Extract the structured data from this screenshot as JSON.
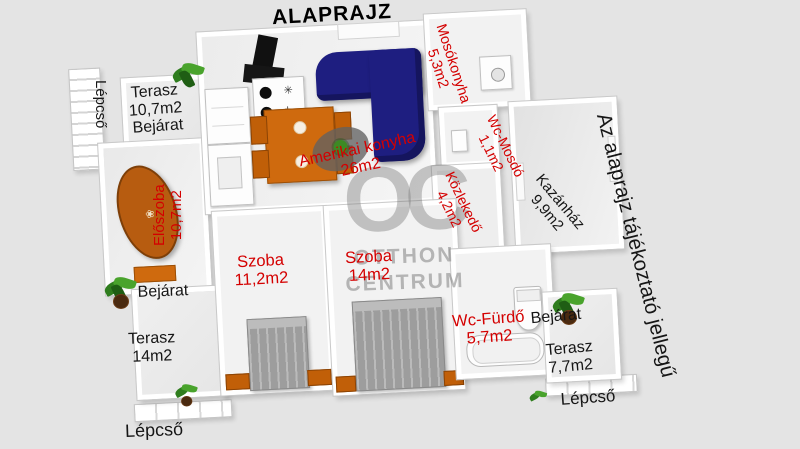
{
  "title": "ALAPRAJZ",
  "disclaimer": "Az alaprajz tájékoztató jellegű",
  "watermark": {
    "logo": "OC",
    "line1": "OTTHON",
    "line2": "CENTRUM"
  },
  "rooms": {
    "terasz_top": {
      "name": "Terasz",
      "area": "10,7m2"
    },
    "eloszoba": {
      "name": "Előszoba",
      "area": "10,7m2"
    },
    "amerikai_konyha": {
      "name": "Amerikai konyha",
      "area": "26m2"
    },
    "mosokonyha": {
      "name": "Mosókonyha",
      "area": "5,3m2"
    },
    "wc_mosdo": {
      "name": "Wc-Mosdó",
      "area": "1,1m2"
    },
    "kozlekedo": {
      "name": "Közlekedő",
      "area": "4,2m2"
    },
    "kazanhaz": {
      "name": "Kazánház",
      "area": "9,9m2"
    },
    "szoba1": {
      "name": "Szoba",
      "area": "11,2m2"
    },
    "szoba2": {
      "name": "Szoba",
      "area": "14m2"
    },
    "wc_furdo": {
      "name": "Wc-Fürdő",
      "area": "5,7m2"
    },
    "terasz_left": {
      "name": "Terasz",
      "area": "14m2"
    },
    "terasz_right": {
      "name": "Terasz",
      "area": "7,7m2"
    }
  },
  "annotations": {
    "bejarat_top": "Bejárat",
    "bejarat_mid": "Bejárat",
    "bejarat_right": "Bejárat",
    "lepcso_top_left": "Lépcső",
    "lepcso_bottom_left": "Lépcső",
    "lepcso_bottom_right": "Lépcső"
  },
  "colors": {
    "background": "#e4e4e4",
    "wall_white": "#ffffff",
    "label_red": "#d40000",
    "label_black": "#161616",
    "sofa_navy": "#1e1e80",
    "furniture_orange": "#cf6a0e",
    "bed_gray": "#9d9d9d",
    "plant_green": "#2f7d1e",
    "watermark_gray": "#767676"
  }
}
